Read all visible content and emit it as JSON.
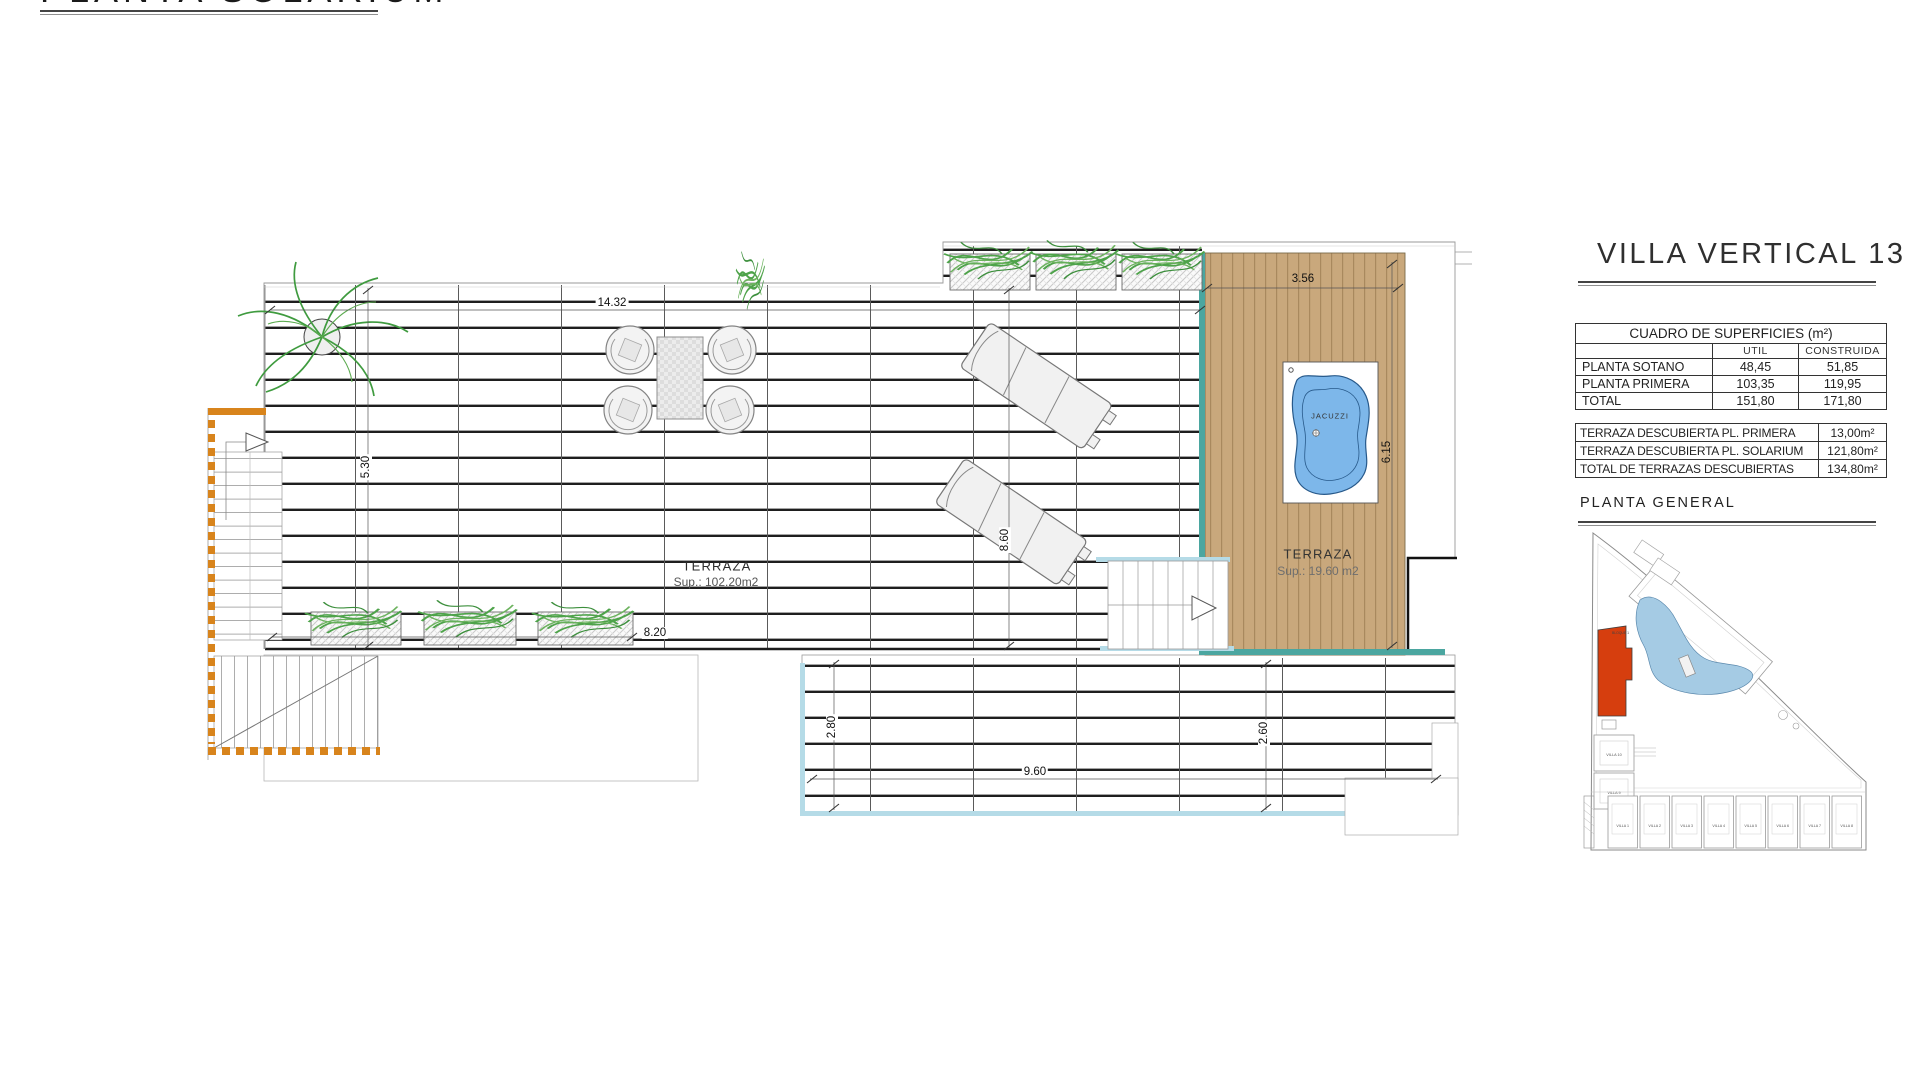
{
  "page_title": "PLANTA SOLARIUM",
  "project": {
    "title": "VILLA VERTICAL 13"
  },
  "surfaces_table": {
    "title": "CUADRO DE SUPERFICIES (m²)",
    "col_util": "UTIL",
    "col_construida": "CONSTRUIDA",
    "rows": [
      {
        "label": "PLANTA SOTANO",
        "util": "48,45",
        "construida": "51,85"
      },
      {
        "label": "PLANTA PRIMERA",
        "util": "103,35",
        "construida": "119,95"
      },
      {
        "label": "TOTAL",
        "util": "151,80",
        "construida": "171,80"
      }
    ]
  },
  "terraces_table": {
    "rows": [
      {
        "label": "TERRAZA DESCUBIERTA PL. PRIMERA",
        "value": "13,00m²"
      },
      {
        "label": "TERRAZA DESCUBIERTA PL. SOLARIUM",
        "value": "121,80m²"
      },
      {
        "label": "TOTAL DE TERRAZAS DESCUBIERTAS",
        "value": "134,80m²"
      }
    ]
  },
  "site_plan": {
    "title": "PLANTA GENERAL",
    "bloque1": "BLOQUE 1",
    "bloque2": "BLOQUE 2",
    "side_villas": [
      "VILLA 10",
      "VILLA 9"
    ],
    "bottom_villas": [
      "VILLA 1",
      "VILLA 2",
      "VILLA 3",
      "VILLA 4",
      "VILLA 5",
      "VILLA 6",
      "VILLA 7",
      "VILLA 8"
    ]
  },
  "plan": {
    "terraza_main": {
      "name": "TERRAZA",
      "sup": "Sup.: 102.20m2"
    },
    "terraza_deck": {
      "name": "TERRAZA",
      "sup": "Sup.: 19.60 m2"
    },
    "jacuzzi": "JACUZZI",
    "dimensions": {
      "top_width": "14.32",
      "left_height": "5.30",
      "planter_row": "8.20",
      "deck_width": "3.56",
      "deck_height": "6.15",
      "mid_height": "8.60",
      "lower_left": "2.80",
      "lower_bottom": "9.60",
      "lower_right": "2.60"
    }
  },
  "colors": {
    "deck_wood": "#c9a87c",
    "deck_plank_line": "#a9895e",
    "teal_edge": "#4ba6a0",
    "light_blue_edge": "#b5dbe7",
    "jacuzzi_water": "#7db7ea",
    "stair_orange": "#d8841c",
    "plant_green": "#4ea34a",
    "site_red_building": "#d63e0e",
    "site_lagoon": "#a5cbe4",
    "drawing_line": "#2a2a2a"
  }
}
